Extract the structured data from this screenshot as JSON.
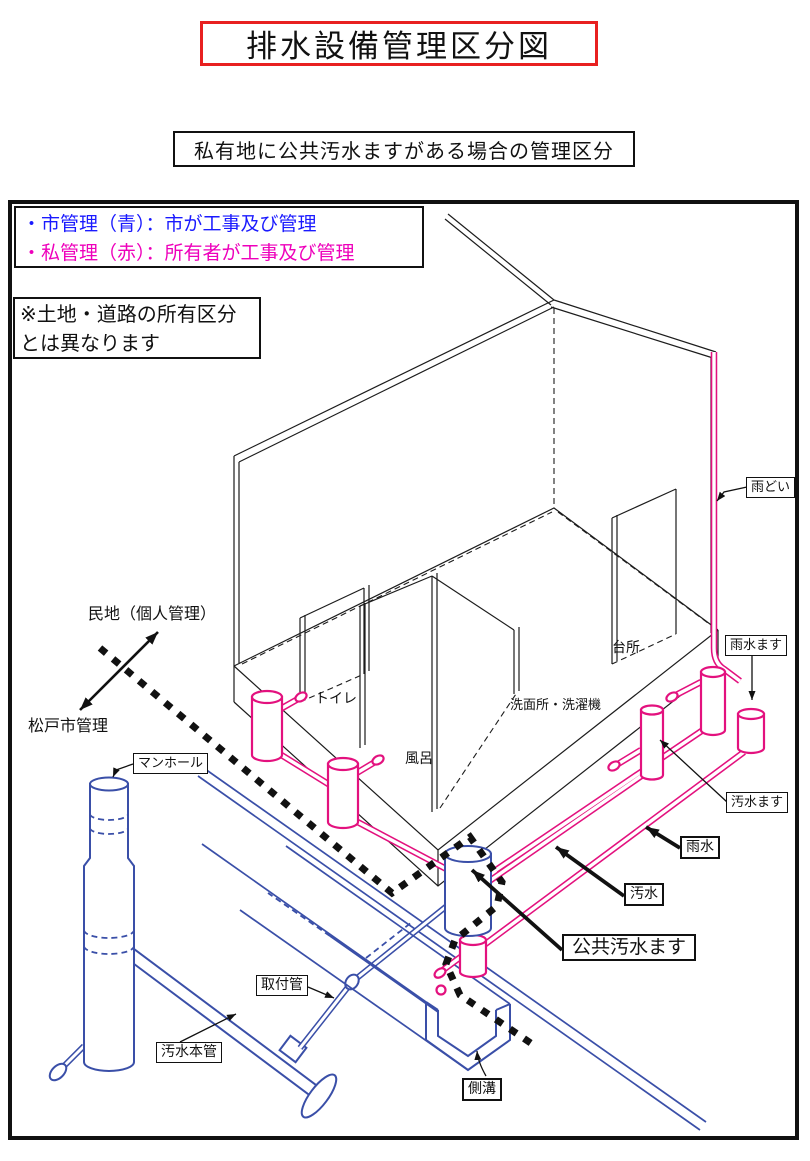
{
  "page": {
    "title": "排水設備管理区分図",
    "subtitle": "私有地に公共汚水ますがある場合の管理区分"
  },
  "legend": {
    "city_line": "・市管理（青）：市が工事及び管理",
    "private_line": "・私管理（赤）：所有者が工事及び管理"
  },
  "note": {
    "line1": "※土地・道路の所有区分",
    "line2": "とは異なります"
  },
  "area_labels": {
    "private_land": "民地（個人管理）",
    "city_managed": "松戸市管理"
  },
  "rooms": {
    "toilet": "トイレ",
    "bath": "風呂",
    "washroom": "洗面所・洗濯機",
    "kitchen": "台所"
  },
  "callouts": {
    "rain_gutter": "雨どい",
    "rainwater_basin": "雨水ます",
    "sewage_basin": "汚水ます",
    "rainwater": "雨水",
    "sewage": "汚水",
    "public_sewage_basin": "公共汚水ます",
    "manhole": "マンホール",
    "connection_pipe": "取付管",
    "sewer_main": "汚水本管",
    "roadside_gutter": "側溝"
  },
  "colors": {
    "legend_blue": "#1a1aff",
    "legend_magenta": "#ee00bb",
    "pipe_magenta": "#e3117e",
    "pipe_blue": "#3a4fa8",
    "border_red": "#e82020"
  }
}
